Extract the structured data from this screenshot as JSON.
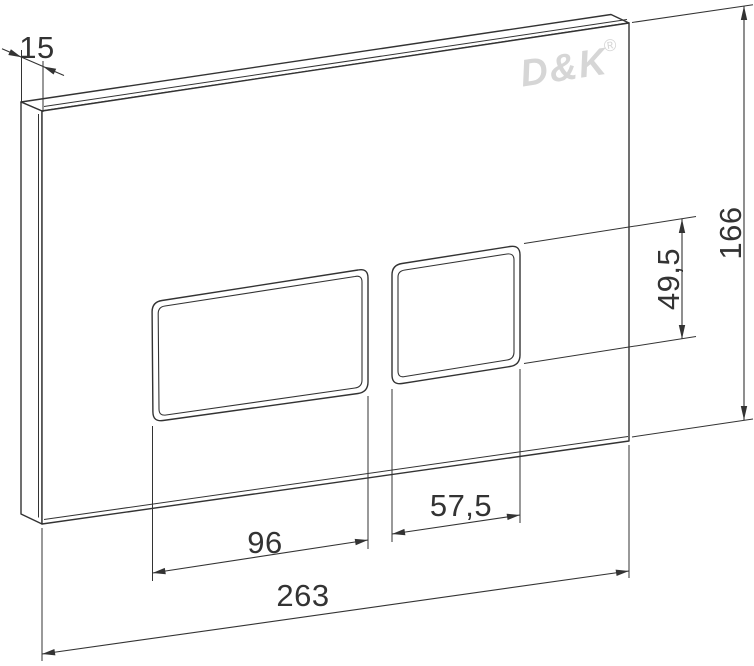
{
  "drawing": {
    "brand": "D&K",
    "registered_mark": "®",
    "dimensions": {
      "thickness": "15",
      "plate_height": "166",
      "button_height": "49,5",
      "large_button_width": "96",
      "small_button_width": "57,5",
      "plate_width": "263"
    },
    "colors": {
      "line": "#333333",
      "logo": "#d6d6d6",
      "background": "#ffffff"
    }
  }
}
